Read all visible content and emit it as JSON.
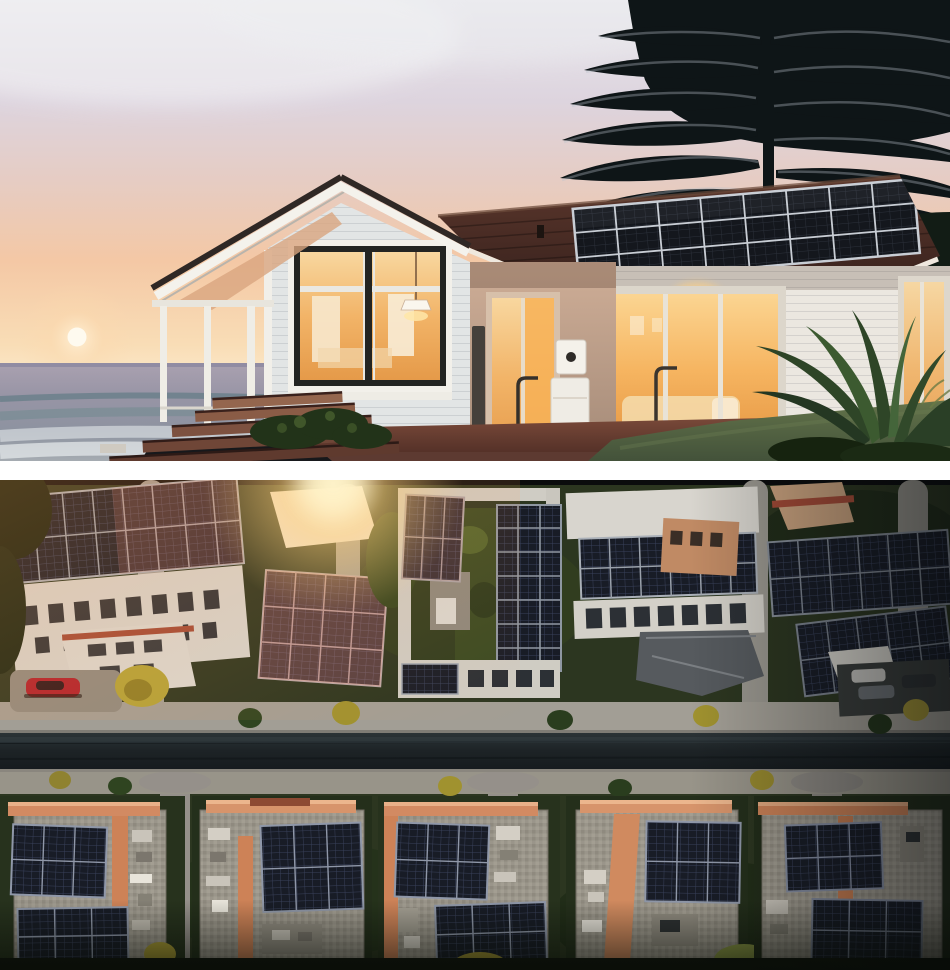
{
  "page": {
    "background": "#ffffff",
    "divider_color": "#ffffff"
  },
  "photos": {
    "hero": {
      "alt": "Modern white beach house with rooftop solar panels at sunset; warm glowing interior lights, low sun over the ocean to the left, tall dark pine tree behind the roof, wooden deck steps and lawn in the foreground",
      "elements": [
        "sunset-sky",
        "sun",
        "ocean-horizon",
        "breaking-wave",
        "shore-rocks",
        "pine-tree",
        "gable-roof",
        "solar-panel-array",
        "picture-window",
        "pendant-lamp",
        "porch-columns",
        "sliding-glass-doors",
        "home-battery-unit",
        "handrail",
        "deck-steps",
        "hedge",
        "lawn",
        "tropical-plants"
      ],
      "colors": {
        "sky_top": "#e9e8ed",
        "sky_peach": "#f5c9a6",
        "sun": "#fdf7e9",
        "ocean": "#9a95a7",
        "wave_teal": "#5d7a82",
        "roof_tile": "#4e2f28",
        "solar_panel": "#14171d",
        "siding_white": "#e7e9e8",
        "window_glow": "#f4b763",
        "tan_wall": "#c5a58f",
        "deck_wood": "#6f4437",
        "lawn": "#57663f",
        "pine_silhouette": "#0e1517"
      }
    },
    "aerial": {
      "alt": "Aerial drone view of a residential neighborhood at sunset; white apartment blocks with dark rooftop solar arrays above a straight road, terracotta courtyard buildings with solar panels below it, sun flare at the upper left and parked cars including a red car",
      "elements": [
        "white-apartment-blocks",
        "rooftop-solar-arrays",
        "courtyard-gardens",
        "road",
        "sidewalk-paths",
        "terracotta-buildings",
        "gravel-courtyards",
        "red-car",
        "parked-cars",
        "yellow-trees",
        "hedges",
        "sun-flare"
      ],
      "colors": {
        "vegetation": "#2c3620",
        "solar_panel": "#181c26",
        "panel_grid": "#39415a",
        "white_roof": "#d6d4cd",
        "terracotta": "#d28a62",
        "gravel": "#9a958a",
        "road_asphalt": "#1d2326",
        "path": "#a29e95",
        "sun_flare": "#ffd27a",
        "red_car": "#b0202c",
        "tree_yellow": "#ac9d35"
      }
    }
  }
}
